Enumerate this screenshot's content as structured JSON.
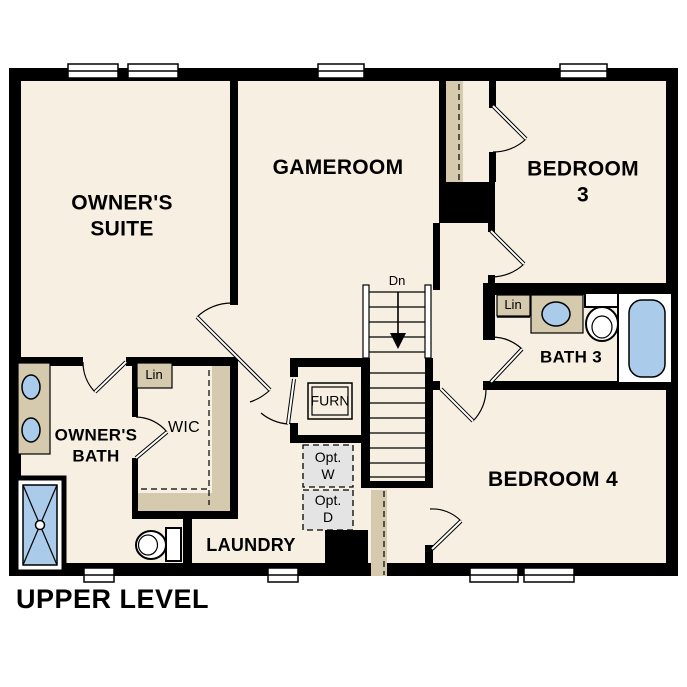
{
  "title": "UPPER LEVEL",
  "rooms": {
    "owners_suite": "OWNER'S\nSUITE",
    "gameroom": "GAMEROOM",
    "bedroom3": "BEDROOM 3",
    "bedroom4": "BEDROOM 4",
    "owners_bath": "OWNER'S\nBATH",
    "wic": "WIC",
    "laundry": "LAUNDRY",
    "bath3": "BATH 3"
  },
  "annotations": {
    "linen_wic": "Lin",
    "linen_bath3": "Lin",
    "furnace": "FURN",
    "optional_washer": "Opt.\nW",
    "optional_dryer": "Opt.\nD",
    "stairs_down": "Dn"
  },
  "colors": {
    "floor": "#f7efe2",
    "shelf": "#d5c9ae",
    "fixture": "#abcbea",
    "optional": "#e4e4e4",
    "wall": "#000000",
    "window": "#ffffff"
  }
}
